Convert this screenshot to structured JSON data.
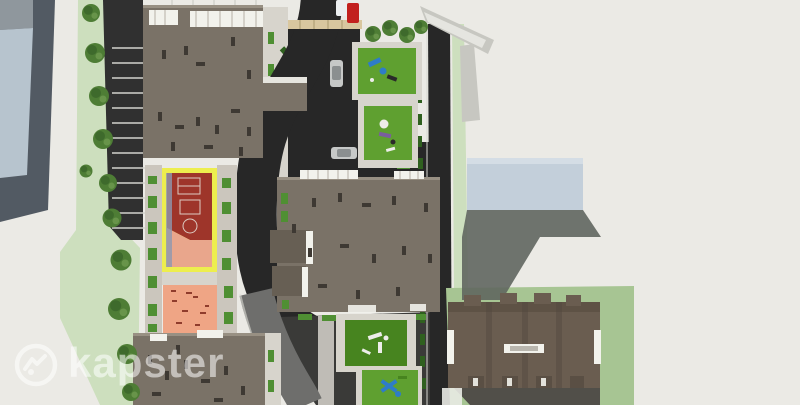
{
  "watermark": {
    "brand": "kapster",
    "logo_icon": "roofline-in-circle-icon"
  },
  "scene": {
    "type": "aerial-3d-architectural-site-plan-render",
    "features": [
      "office-building-west",
      "tree-row-west",
      "parking-lot",
      "apartment-building-north",
      "apartment-building-central",
      "apartment-building-south-west",
      "apartment-building-south-east-pitched",
      "warehouse-building-east",
      "wall-structure-north-east",
      "basketball-court-yellow-border",
      "sand-playground",
      "green-playground-1",
      "green-playground-2",
      "green-playground-3",
      "green-playground-4",
      "s-curve-road",
      "east-road",
      "gray-access-road",
      "crosswalk",
      "red-truck",
      "silver-car-horizontal",
      "silver-car-vertical"
    ]
  },
  "colors": {
    "bg": "#EBEAE5",
    "grass-band": "#CDDFBE",
    "lawn": "#A7C593",
    "tree": "#4E7D35",
    "tree-dark": "#39642A",
    "tree-light": "#6F9A50",
    "hedge": "#4F8F33",
    "hedge-dark": "#2F601F",
    "asphalt": "#303030",
    "asphalt-dark": "#272727",
    "road-gray": "#6E6E6C",
    "plaza": "#3A3A38",
    "roof": "#7A7267",
    "roof-edge": "#9B9386",
    "roof-dark": "#675F54",
    "roof-pitched": "#6A5D50",
    "pitched-shade": "#53483D",
    "slate": "#525A63",
    "slate-light": "#8F979D",
    "blue-panel": "#B7C4CE",
    "blue-bldg": "#C3CFDA",
    "shadow": "#60665F",
    "court-yellow": "#EDEE4E",
    "court-red": "#9E352A",
    "court-salmon": "#E9A68C",
    "court-track-blue": "#8D99B0",
    "sand": "#EFA585",
    "sand-mark": "#8F3C2C",
    "pg-green": "#5FA030",
    "pg-green-dark": "#47841F",
    "path": "#D7D4CC",
    "mosaic": "#CBC6BD",
    "crosswalk": "#D9C79F",
    "vehicle-red": "#C2201E",
    "white-detail": "#F2F2EC",
    "car-silver": "#C6C8C7",
    "car-glass": "#8B8F90",
    "wall-gray": "#C7C7C1",
    "vent": "#3E3933",
    "park-line": "#D3D3CD",
    "equip-blue": "#2E7CC9",
    "equip-purple": "#7A5E9E",
    "statue-white": "#EDEDEA",
    "ground-dark": "#514F49",
    "watermark": "rgba(255,255,255,0.55)"
  }
}
